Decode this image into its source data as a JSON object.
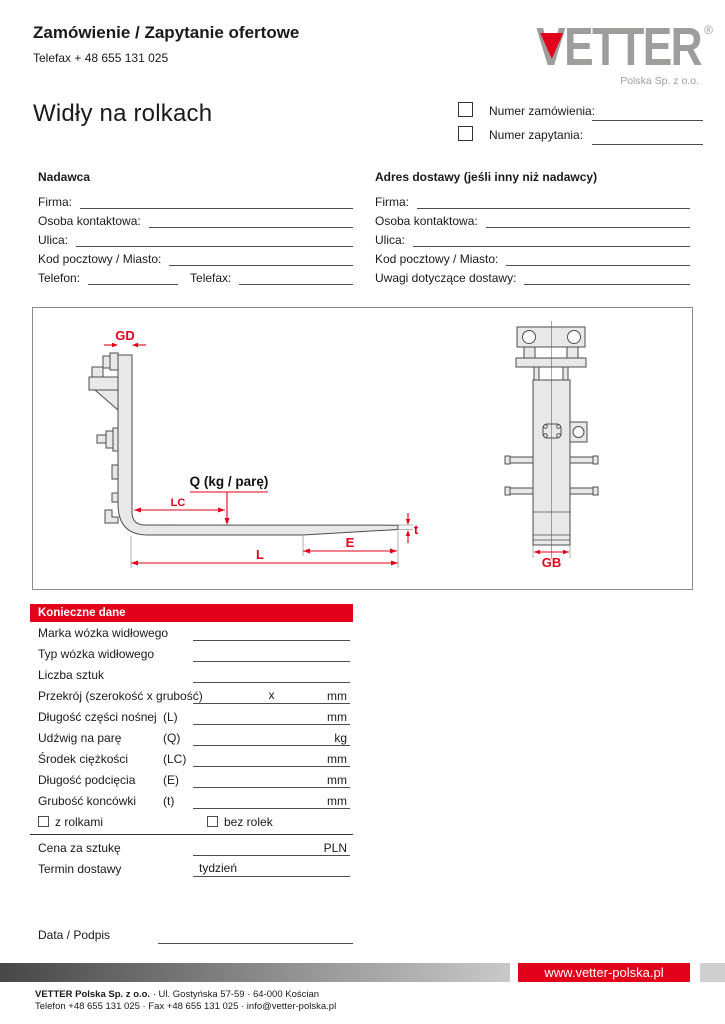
{
  "header": {
    "title": "Zamówienie / Zapytanie ofertowe",
    "telefax": "Telefax + 48 655 131 025",
    "product_title": "Widły na rolkach",
    "logo": {
      "brand": "VETTER",
      "registered": "®",
      "subtitle": "Polska Sp. z o.o."
    },
    "order_number_label": "Numer zamówienia:",
    "inquiry_number_label": "Numer zapytania:"
  },
  "sender": {
    "heading": "Nadawca",
    "fields": [
      "Firma:",
      "Osoba kontaktowa:",
      "Ulica:",
      "Kod pocztowy / Miasto:"
    ],
    "phone_label": "Telefon:",
    "fax_label": "Telefax:"
  },
  "delivery": {
    "heading": "Adres dostawy (jeśli inny niż nadawcy)",
    "fields": [
      "Firma:",
      "Osoba kontaktowa:",
      "Ulica:",
      "Kod pocztowy / Miasto:",
      "Uwagi dotyczące dostawy:"
    ]
  },
  "diagram": {
    "labels": {
      "gd": "GD",
      "q": "Q (kg / parę)",
      "lc": "LC",
      "l": "L",
      "e": "E",
      "t": "t",
      "gb": "GB"
    }
  },
  "table": {
    "heading": "Konieczne dane",
    "rows": [
      {
        "label": "Marka wózka widłowego",
        "code": "",
        "value": "",
        "unit": ""
      },
      {
        "label": "Typ wózka widłowego",
        "code": "",
        "value": "",
        "unit": ""
      },
      {
        "label": "Liczba sztuk",
        "code": "",
        "value": "",
        "unit": ""
      },
      {
        "label": "Przekrój (szerokość x grubość)",
        "code": "",
        "value": "x",
        "unit": "mm"
      },
      {
        "label": "Długość części nośnej",
        "code": "(L)",
        "value": "",
        "unit": "mm"
      },
      {
        "label": "Udźwig na parę",
        "code": "(Q)",
        "value": "",
        "unit": "kg"
      },
      {
        "label": "Środek ciężkości",
        "code": "(LC)",
        "value": "",
        "unit": "mm"
      },
      {
        "label": "Długość podcięcia",
        "code": "(E)",
        "value": "",
        "unit": "mm"
      },
      {
        "label": "Grubość koncówki",
        "code": "(t)",
        "value": "",
        "unit": "mm"
      }
    ],
    "checkbox_with_rollers": "z rolkami",
    "checkbox_without_rollers": "bez rolek",
    "price_row": {
      "label": "Cena za sztukę",
      "unit": "PLN"
    },
    "delivery_row": {
      "label": "Termin dostawy",
      "value": "tydzień"
    }
  },
  "signature_label": "Data / Podpis",
  "footer": {
    "website": "www.vetter-polska.pl",
    "company_bold": "VETTER Polska Sp. z o.o.",
    "address_rest": " · Ul. Gostyńska 57-59 · 64-000 Kościan",
    "contact_line": "Telefon +48 655 131 025 · Fax +48 655 131 025 · info@vetter-polska.pl"
  },
  "colors": {
    "red": "#e2001a",
    "logo_gray": "#9d9d9c"
  }
}
